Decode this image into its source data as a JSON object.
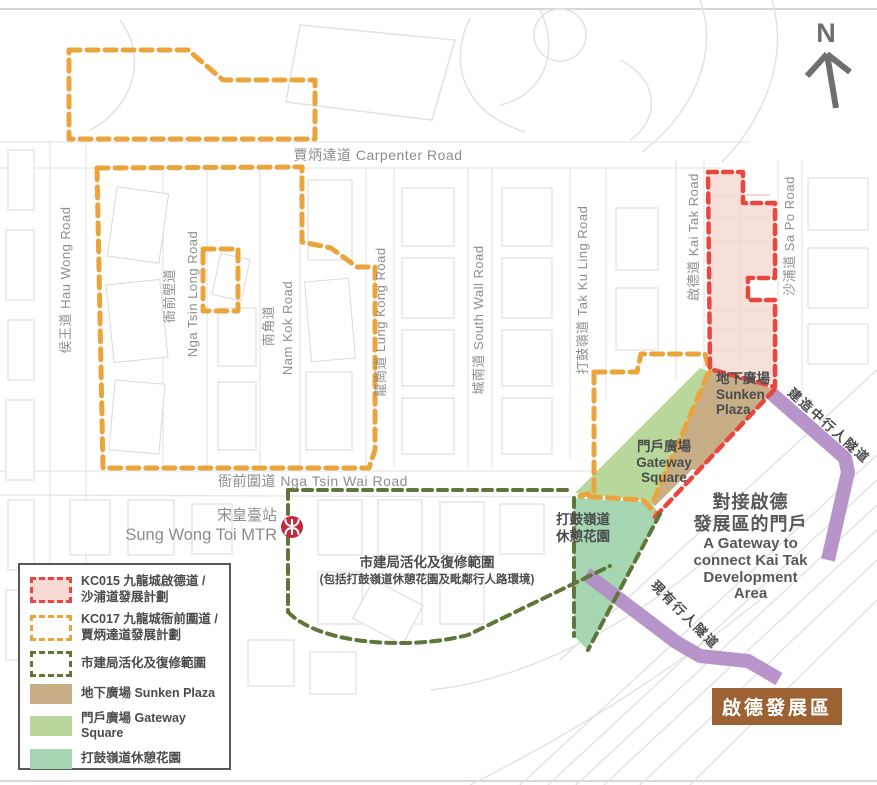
{
  "north": {
    "label": "N"
  },
  "roads": {
    "carpenter": "賈炳達道 Carpenter Road",
    "hau_wong": "侯王道 Hau Wong Road",
    "nga_tsin_long_cn": "衙前塱道",
    "nga_tsin_long_en": "Nga Tsin Long Road",
    "nam_kok_cn": "南角道",
    "nam_kok_en": "Nam Kok Road",
    "lung_kong": "龍崗道 Lung Kong Road",
    "south_wall": "城南道 South Wall Road",
    "tak_ku_ling": "打鼓嶺道 Tak Ku Ling Road",
    "kai_tak": "啟德道 Kai Tak Road",
    "sa_po": "沙浦道 Sa Po Road",
    "nga_tsin_wai": "衙前圍道 Nga Tsin Wai Road"
  },
  "station": {
    "name_cn": "宋皇臺站",
    "name_en": "Sung Wong Toi MTR"
  },
  "areas": {
    "sunken_plaza": {
      "line1": "地下廣場",
      "line2": "Sunken",
      "line3": "Plaza"
    },
    "gateway_square": {
      "line1": "門戶廣場",
      "line2": "Gateway",
      "line3": "Square"
    },
    "garden": {
      "line1": "打鼓嶺道",
      "line2": "休憩花園"
    }
  },
  "ura_note": {
    "line1": "市建局活化及復修範圍",
    "line2": "(包括打鼓嶺道休憩花園及毗鄰行人路環境)"
  },
  "tunnels": {
    "under_construction": "建造中行人隧道",
    "existing": "現有行人隧道"
  },
  "callout": {
    "cn1": "對接啟德",
    "cn2": "發展區的門戶",
    "en1": "A Gateway to",
    "en2": "connect Kai Tak",
    "en3": "Development",
    "en4": "Area"
  },
  "kai_tak_area": {
    "label": "啟德發展區"
  },
  "legend": {
    "items": [
      {
        "swatch": "red-dashed",
        "label_line1": "KC015 九龍城啟德道 /",
        "label_line2": "沙浦道發展計劃"
      },
      {
        "swatch": "orange-dashed",
        "label_line1": "KC017 九龍城衙前圍道 /",
        "label_line2": "賈炳達道發展計劃"
      },
      {
        "swatch": "green-dashed",
        "label_line1": "市建局活化及復修範圍",
        "label_line2": ""
      },
      {
        "swatch": "tan",
        "label_line1": "地下廣場 Sunken Plaza",
        "label_line2": ""
      },
      {
        "swatch": "light-green",
        "label_line1": "門戶廣場 Gateway Square",
        "label_line2": ""
      },
      {
        "swatch": "teal",
        "label_line1": "打鼓嶺道休憩花園",
        "label_line2": ""
      }
    ]
  },
  "colors": {
    "kc015_red": "#E8473F",
    "kc015_fill": "#F7DAD3",
    "kc017_orange": "#EBA43C",
    "ura_green": "#5F7638",
    "sunken_plaza_tan": "#C7AE87",
    "gateway_square_green": "#B9D79B",
    "garden_teal": "#A5D5B1",
    "tunnel_purple": "#B18CC6",
    "kai_tak_brown": "#9C6233",
    "mtr_red": "#BE2C3E"
  }
}
